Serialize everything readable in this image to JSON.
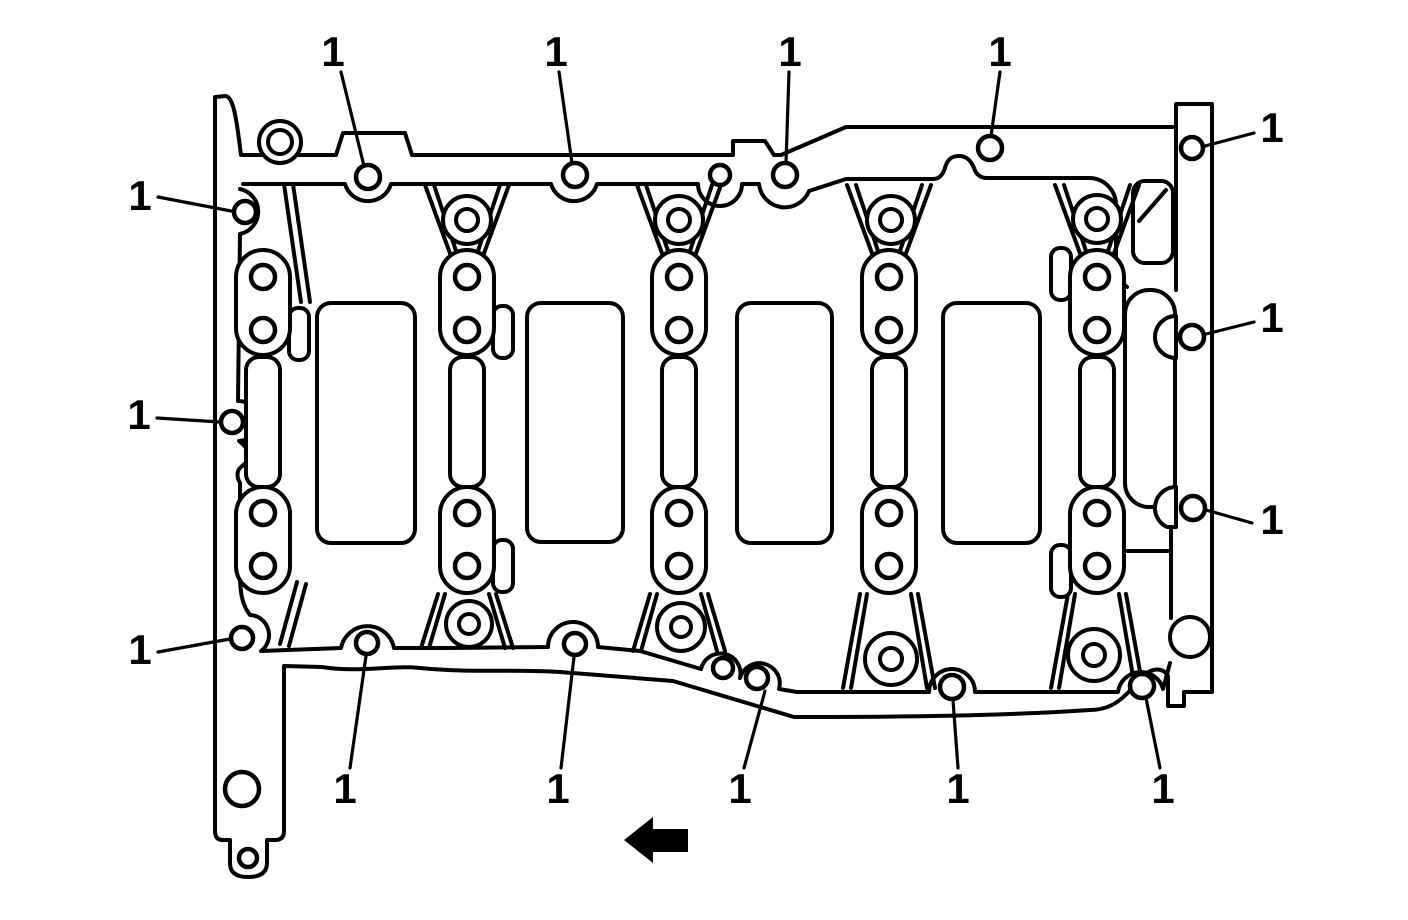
{
  "figure": {
    "description": "Engine cylinder block oil pan rail - sealing surface bolt hole locations",
    "callout_label_meaning": "oil pan bolt hole",
    "background_color": "#ffffff",
    "line_color": "#000000",
    "arrow": {
      "name": "front-of-engine-arrow",
      "direction": "left",
      "color": "#000000"
    }
  },
  "callouts": [
    {
      "id": "top-1",
      "label": "1",
      "label_x": 333,
      "label_y": 66,
      "leader": [
        341,
        72,
        364,
        166
      ],
      "hole": [
        368,
        177,
        12
      ]
    },
    {
      "id": "top-2",
      "label": "1",
      "label_x": 556,
      "label_y": 66,
      "leader": [
        559,
        72,
        572,
        163
      ],
      "hole": [
        575,
        175,
        12
      ]
    },
    {
      "id": "top-3",
      "label": "1",
      "label_x": 790,
      "label_y": 66,
      "leader": [
        789,
        72,
        786,
        163
      ],
      "hole": [
        785,
        175,
        12
      ]
    },
    {
      "id": "top-4",
      "label": "1",
      "label_x": 1000,
      "label_y": 66,
      "leader": [
        1000,
        72,
        991,
        136
      ],
      "hole": [
        990,
        148,
        12
      ]
    },
    {
      "id": "right-1",
      "label": "1",
      "label_x": 1272,
      "label_y": 142,
      "leader": [
        1254,
        133,
        1205,
        146
      ],
      "hole": [
        1192,
        148,
        11
      ]
    },
    {
      "id": "right-2",
      "label": "1",
      "label_x": 1272,
      "label_y": 332,
      "leader": [
        1254,
        322,
        1206,
        334
      ],
      "hole": [
        1192,
        337,
        12
      ]
    },
    {
      "id": "right-3",
      "label": "1",
      "label_x": 1272,
      "label_y": 534,
      "leader": [
        1252,
        523,
        1206,
        510
      ],
      "hole": [
        1193,
        508,
        12
      ]
    },
    {
      "id": "left-1",
      "label": "1",
      "label_x": 140,
      "label_y": 210,
      "leader": [
        158,
        197,
        231,
        211
      ],
      "hole": [
        245,
        212,
        11
      ]
    },
    {
      "id": "left-2",
      "label": "1",
      "label_x": 139,
      "label_y": 429,
      "leader": [
        157,
        418,
        220,
        422
      ],
      "hole": [
        232,
        422,
        11
      ]
    },
    {
      "id": "left-3",
      "label": "1",
      "label_x": 140,
      "label_y": 664,
      "leader": [
        158,
        652,
        230,
        639
      ],
      "hole": [
        242,
        638,
        11
      ]
    },
    {
      "id": "bottom-1",
      "label": "1",
      "label_x": 345,
      "label_y": 803,
      "leader": [
        350,
        768,
        366,
        656
      ],
      "hole": [
        367,
        643,
        11
      ]
    },
    {
      "id": "bottom-2",
      "label": "1",
      "label_x": 558,
      "label_y": 803,
      "leader": [
        561,
        768,
        574,
        657
      ],
      "hole": [
        575,
        644,
        11
      ]
    },
    {
      "id": "bottom-3",
      "label": "1",
      "label_x": 740,
      "label_y": 803,
      "leader": [
        744,
        768,
        765,
        691
      ],
      "hole": [
        757,
        678,
        11
      ]
    },
    {
      "id": "bottom-4",
      "label": "1",
      "label_x": 958,
      "label_y": 803,
      "leader": [
        958,
        768,
        953,
        700
      ],
      "hole": [
        952,
        687,
        12
      ]
    },
    {
      "id": "bottom-5",
      "label": "1",
      "label_x": 1163,
      "label_y": 803,
      "leader": [
        1160,
        768,
        1146,
        698
      ],
      "hole": [
        1142,
        686,
        12
      ]
    }
  ],
  "unlabeled_holes": [
    [
      720,
      175,
      10
    ],
    [
      723,
      668,
      10
    ]
  ]
}
